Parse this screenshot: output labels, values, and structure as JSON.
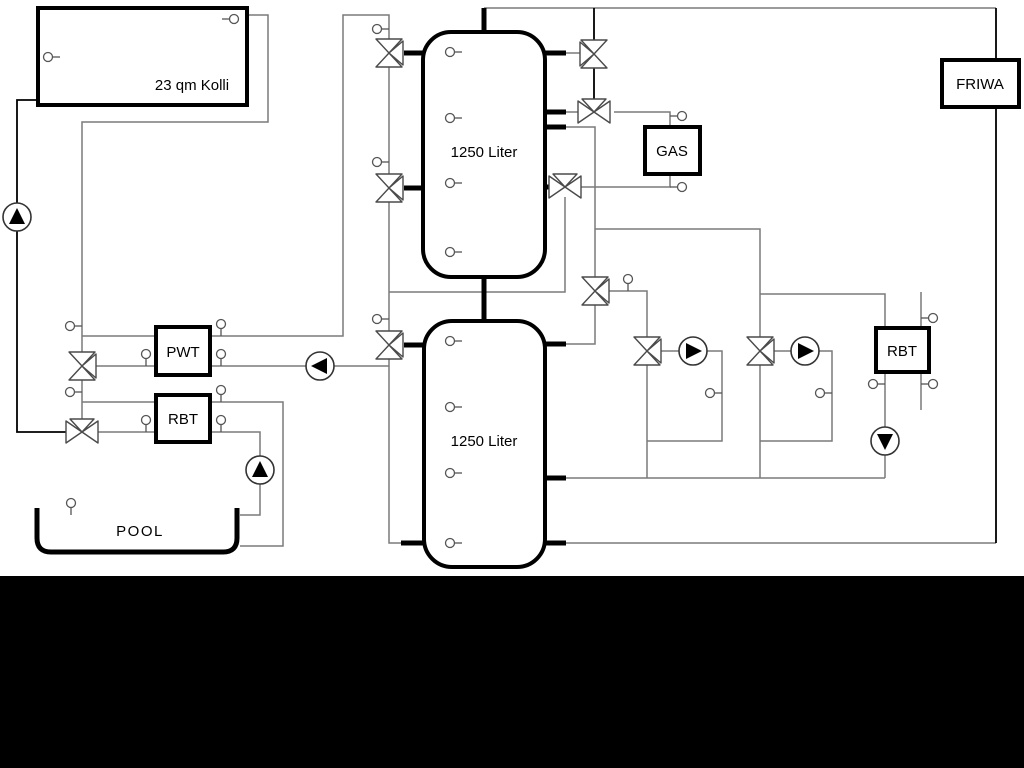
{
  "diagram": {
    "labels": {
      "collector": "23 qm Kolli",
      "tank_top": "1250 Liter",
      "tank_bottom": "1250 Liter",
      "pwt": "PWT",
      "rbt_left": "RBT",
      "gas": "GAS",
      "friwa": "FRIWA",
      "rbt_right": "RBT",
      "pool": "POOL"
    },
    "colors": {
      "background": "#ffffff",
      "footer_band": "#000000",
      "pipe_gray": "#7a7a7a",
      "pipe_black": "#000000",
      "component_stroke": "#4a4a4a"
    },
    "icons": {
      "pump": "circle-with-solid-triangle",
      "three_way_valve": "double-triangle-bowtie-with-branch",
      "temp_sensor": "small-circle-with-stem"
    }
  }
}
